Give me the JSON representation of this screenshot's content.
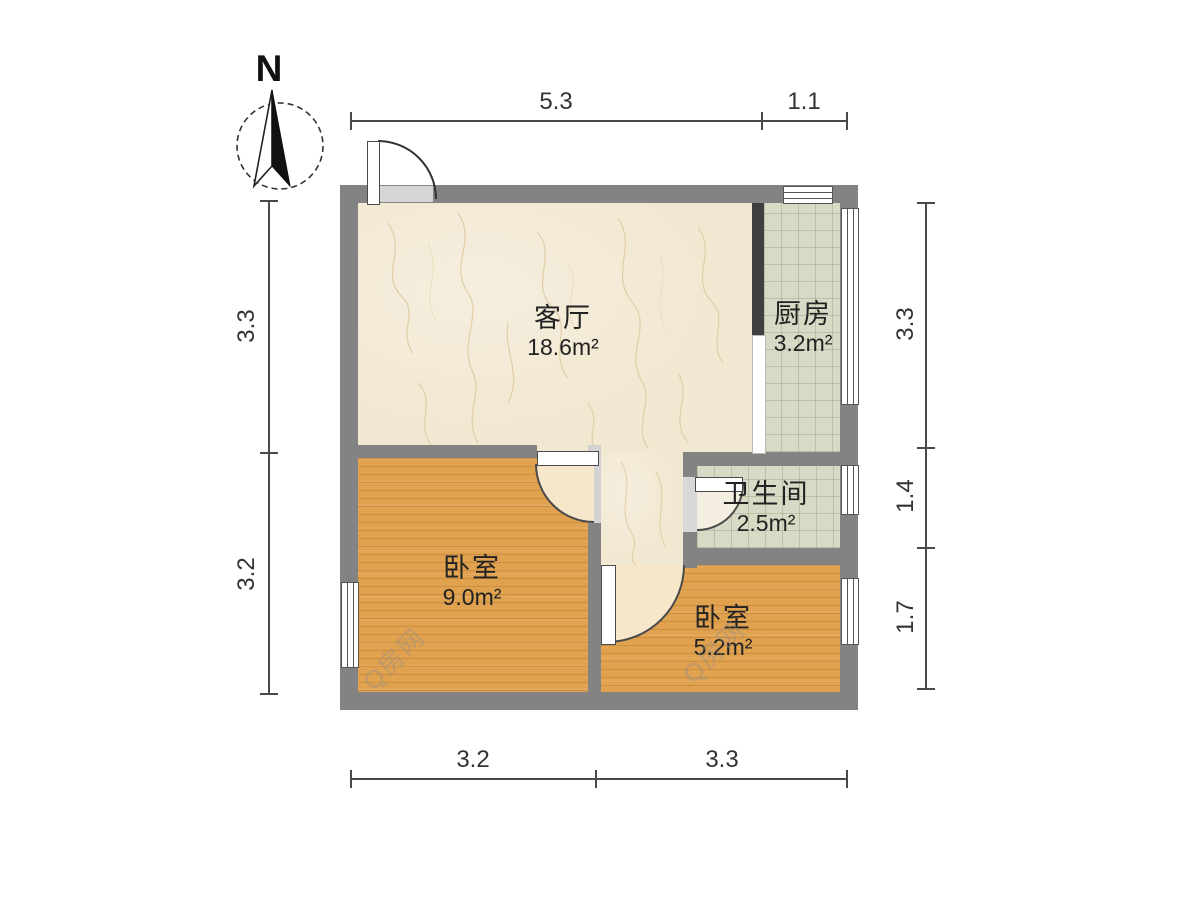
{
  "compass": {
    "label": "N"
  },
  "rooms": {
    "living": {
      "name": "客厅",
      "area": "18.6m²"
    },
    "kitchen": {
      "name": "厨房",
      "area": "3.2m²"
    },
    "bathroom": {
      "name": "卫生间",
      "area": "2.5m²"
    },
    "bedroom_main": {
      "name": "卧室",
      "area": "9.0m²"
    },
    "bedroom_second": {
      "name": "卧室",
      "area": "5.2m²"
    }
  },
  "dimensions": {
    "top": {
      "a": "5.3",
      "b": "1.1"
    },
    "bottom": {
      "a": "3.2",
      "b": "3.3"
    },
    "left": {
      "a": "3.3",
      "b": "3.2"
    },
    "right": {
      "a": "3.3",
      "b": "1.4",
      "c": "1.7"
    }
  },
  "watermark": {
    "text": "Q房网"
  },
  "colors": {
    "wall": "#838383",
    "dark_wall": "#3f3f3f",
    "living_floor": "#f2e8d2",
    "tile_floor": "#d9dac6",
    "wood_floor": "#e0a24f",
    "label": "#222222",
    "dimension": "#4a4a4a"
  }
}
